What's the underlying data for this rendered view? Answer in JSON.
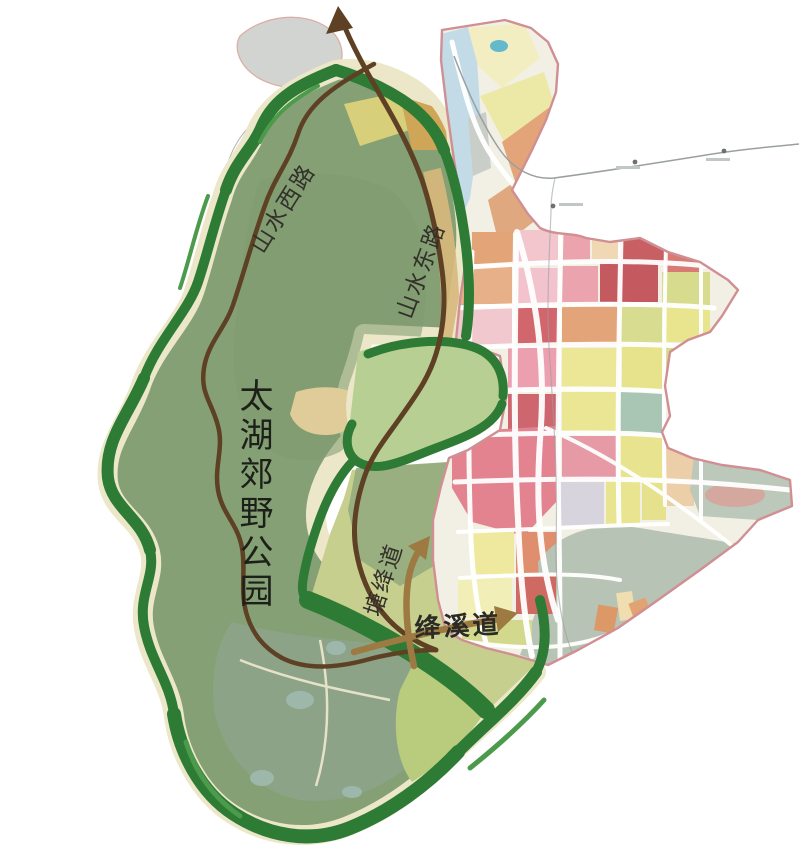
{
  "page": {
    "background": "#ffffff"
  },
  "park": {
    "title": "太湖郊野公园",
    "boundary_color": "#2e7b35",
    "boundary_highlight_color": "#4c9a4b",
    "fill_color": "#85a075",
    "shore_color": "#ece7c8",
    "hill_color": "#b8cf93"
  },
  "roads": {
    "loop_color": "#5e4024",
    "west_label": "山水西路",
    "east_label": "山水东路"
  },
  "arrows": {
    "color": "#9c7a42",
    "tang_label": "塘绛道",
    "jiangxi_label": "绛溪道"
  },
  "urban": {
    "boundary_color": "#d08f93",
    "base_color": "#f2f0e4",
    "street_color": "#ffffff",
    "railway_color": "#9aa0a0",
    "station_count": 3,
    "palette": {
      "pink": "#f2c3cd",
      "rose": "#ea9fae",
      "red": "#cc5f66",
      "orange": "#e2a478",
      "light_orange": "#eccfa9",
      "yellow": "#eae58f",
      "yellow_green": "#d6db8e",
      "pale_yellow": "#f3efc2",
      "light_blue": "#c3dbe7",
      "teal": "#9fc0b4",
      "gray_green": "#b7c3b5",
      "lavender": "#d8d4de",
      "gray": "#c9cec9"
    }
  }
}
